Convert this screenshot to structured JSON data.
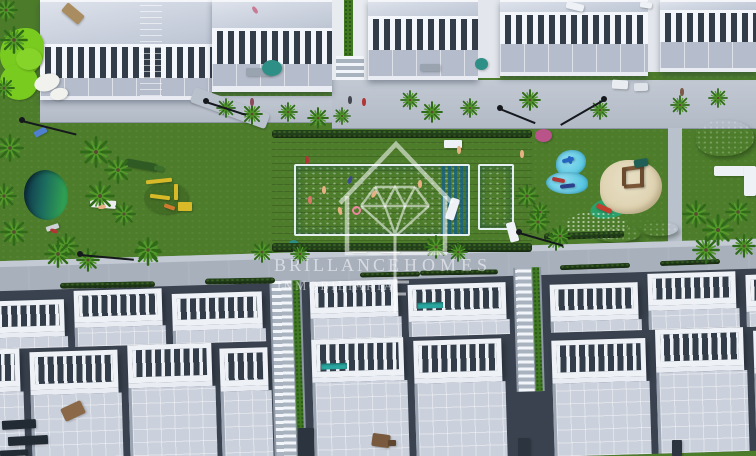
{
  "watermark": {
    "brand_left": "BRILLANCE",
    "brand_right": "HOMES",
    "subtitle": "INMOBILIARIA",
    "logo": "house-outline-with-diamond-and-plumb-line"
  },
  "colors": {
    "lawn": "#4d7d2b",
    "golf": "#79cb1f",
    "pool": "#2aa7da",
    "splash": "#58c7e2",
    "deck": "#84654c",
    "hedge": "#24421c",
    "white": "#eef1f6",
    "roof": "#c9d0dd",
    "terr": "#b5bdcc",
    "win": "#333d49",
    "road": "#a8b0bc",
    "walk": "#c3cad4",
    "sand": "#ddd1af",
    "pond": "#1b6b5e",
    "palm": "#3c7a1e",
    "wm": "rgba(255,255,255,0.55)"
  },
  "scene": {
    "palms": [
      {
        "x": 6,
        "y": 10,
        "s": 24
      },
      {
        "x": 14,
        "y": 40,
        "s": 28
      },
      {
        "x": 4,
        "y": 88,
        "s": 22
      },
      {
        "x": 10,
        "y": 148,
        "s": 28
      },
      {
        "x": 4,
        "y": 196,
        "s": 26
      },
      {
        "x": 14,
        "y": 232,
        "s": 28
      },
      {
        "x": 96,
        "y": 152,
        "s": 32
      },
      {
        "x": 118,
        "y": 170,
        "s": 28
      },
      {
        "x": 100,
        "y": 196,
        "s": 30
      },
      {
        "x": 124,
        "y": 214,
        "s": 24
      },
      {
        "x": 66,
        "y": 246,
        "s": 26
      },
      {
        "x": 148,
        "y": 252,
        "s": 28
      },
      {
        "x": 226,
        "y": 108,
        "s": 20
      },
      {
        "x": 252,
        "y": 114,
        "s": 22
      },
      {
        "x": 288,
        "y": 112,
        "s": 20
      },
      {
        "x": 318,
        "y": 118,
        "s": 22
      },
      {
        "x": 342,
        "y": 116,
        "s": 18
      },
      {
        "x": 410,
        "y": 100,
        "s": 20
      },
      {
        "x": 432,
        "y": 112,
        "s": 22
      },
      {
        "x": 470,
        "y": 108,
        "s": 20
      },
      {
        "x": 530,
        "y": 100,
        "s": 22
      },
      {
        "x": 600,
        "y": 110,
        "s": 20
      },
      {
        "x": 680,
        "y": 105,
        "s": 20
      },
      {
        "x": 718,
        "y": 98,
        "s": 20
      },
      {
        "x": 527,
        "y": 196,
        "s": 24
      },
      {
        "x": 540,
        "y": 212,
        "s": 20
      },
      {
        "x": 538,
        "y": 222,
        "s": 24
      },
      {
        "x": 556,
        "y": 240,
        "s": 22
      },
      {
        "x": 696,
        "y": 214,
        "s": 28
      },
      {
        "x": 718,
        "y": 230,
        "s": 32
      },
      {
        "x": 738,
        "y": 212,
        "s": 26
      },
      {
        "x": 706,
        "y": 250,
        "s": 28
      },
      {
        "x": 744,
        "y": 246,
        "s": 24
      },
      {
        "x": 58,
        "y": 254,
        "s": 28
      },
      {
        "x": 88,
        "y": 260,
        "s": 24
      },
      {
        "x": 148,
        "y": 250,
        "s": 26
      },
      {
        "x": 262,
        "y": 252,
        "s": 22
      },
      {
        "x": 300,
        "y": 254,
        "s": 20
      },
      {
        "x": 436,
        "y": 247,
        "s": 24
      },
      {
        "x": 458,
        "y": 252,
        "s": 20
      },
      {
        "x": 560,
        "y": 236,
        "s": 22
      }
    ],
    "lamps": [
      {
        "x": 22,
        "y": 120,
        "a": 14,
        "l": 56
      },
      {
        "x": 206,
        "y": 101,
        "a": 18,
        "l": 42
      },
      {
        "x": 604,
        "y": 99,
        "a": 150,
        "l": 50
      },
      {
        "x": 80,
        "y": 254,
        "a": 5,
        "l": 54
      },
      {
        "x": 519,
        "y": 232,
        "a": 16,
        "l": 46
      },
      {
        "x": 500,
        "y": 108,
        "a": 22,
        "l": 38
      }
    ],
    "people": [
      {
        "x": 253,
        "y": 6,
        "c": "#c97b93",
        "r": -35
      },
      {
        "x": 322,
        "y": 186,
        "c": "#e8b184",
        "r": 0
      },
      {
        "x": 348,
        "y": 176,
        "c": "#3b4a8c",
        "r": 20
      },
      {
        "x": 338,
        "y": 207,
        "c": "#e8b184",
        "r": -15
      },
      {
        "x": 308,
        "y": 196,
        "c": "#d77766",
        "r": 0
      },
      {
        "x": 372,
        "y": 190,
        "c": "#e8b184",
        "r": 30
      },
      {
        "x": 418,
        "y": 180,
        "c": "#e8b184",
        "r": 0
      },
      {
        "x": 457,
        "y": 146,
        "c": "#e8b184",
        "r": 0
      },
      {
        "x": 305,
        "y": 156,
        "c": "#b03636",
        "r": 0
      },
      {
        "x": 348,
        "y": 96,
        "c": "#44474f",
        "r": 0
      },
      {
        "x": 362,
        "y": 98,
        "c": "#b03636",
        "r": 0
      },
      {
        "x": 100,
        "y": 203,
        "c": "#e8b184",
        "r": 80
      },
      {
        "x": 52,
        "y": 227,
        "c": "#b03636",
        "r": -70
      },
      {
        "x": 520,
        "y": 150,
        "c": "#e8b184",
        "r": 0
      },
      {
        "x": 568,
        "y": 156,
        "c": "#2565c0",
        "r": -15
      },
      {
        "x": 680,
        "y": 88,
        "c": "#7a5a46",
        "r": 0
      },
      {
        "x": 250,
        "y": 98,
        "c": "#8a4a5a",
        "r": 0
      }
    ],
    "hedges": [
      {
        "x": 272,
        "y": 130,
        "w": 260,
        "h": 8,
        "r": 0
      },
      {
        "x": 272,
        "y": 243,
        "w": 260,
        "h": 9,
        "r": 0
      },
      {
        "x": 544,
        "y": 232,
        "w": 80,
        "h": 7,
        "r": -2
      },
      {
        "x": 60,
        "y": 282,
        "w": 95,
        "h": 6,
        "r": -1
      },
      {
        "x": 205,
        "y": 278,
        "w": 70,
        "h": 6,
        "r": -1
      },
      {
        "x": 360,
        "y": 272,
        "w": 60,
        "h": 5,
        "r": -1
      },
      {
        "x": 420,
        "y": 270,
        "w": 78,
        "h": 5,
        "r": -1
      },
      {
        "x": 560,
        "y": 264,
        "w": 70,
        "h": 5,
        "r": -2
      },
      {
        "x": 660,
        "y": 260,
        "w": 60,
        "h": 5,
        "r": -2
      }
    ],
    "props": [
      {
        "n": "golf-green",
        "x": 0,
        "y": 28,
        "w": 44,
        "h": 48,
        "c": "#79cb1f",
        "r": 0,
        "br": "60% 40% 55% 45%"
      },
      {
        "n": "golf-green",
        "x": 0,
        "y": 64,
        "w": 38,
        "h": 36,
        "c": "#79cb1f",
        "r": 0,
        "br": "50%"
      },
      {
        "n": "golf-green",
        "x": 16,
        "y": 48,
        "w": 26,
        "h": 22,
        "c": "#86d32a",
        "r": 0,
        "br": "50%"
      },
      {
        "n": "sand-bunker",
        "x": 34,
        "y": 74,
        "w": 26,
        "h": 17,
        "c": "#f1f2ee",
        "r": -18,
        "br": "50%"
      },
      {
        "n": "sand-bunker",
        "x": 50,
        "y": 88,
        "w": 18,
        "h": 12,
        "c": "#f1f2ee",
        "r": -12,
        "br": "50%"
      },
      {
        "n": "roof-lounger",
        "x": 62,
        "y": 8,
        "w": 22,
        "h": 11,
        "c": "#a98c5f",
        "r": 40,
        "br": "2px"
      },
      {
        "n": "roof-lounger",
        "x": 566,
        "y": 3,
        "w": 18,
        "h": 7,
        "c": "#eef2f7",
        "r": 14,
        "br": "2px"
      },
      {
        "n": "roof-lounger",
        "x": 640,
        "y": 2,
        "w": 12,
        "h": 6,
        "c": "#eef2f7",
        "r": 8,
        "br": "2px"
      },
      {
        "n": "planter",
        "x": 246,
        "y": 68,
        "w": 26,
        "h": 8,
        "c": "#9aa3b0",
        "r": 0,
        "br": "1px"
      },
      {
        "n": "planter",
        "x": 420,
        "y": 64,
        "w": 20,
        "h": 7,
        "c": "#9aa3b0",
        "r": 0,
        "br": "1px"
      },
      {
        "n": "parked-car",
        "x": 612,
        "y": 80,
        "w": 16,
        "h": 9,
        "c": "#e9edf2",
        "r": 3,
        "br": "2px"
      },
      {
        "n": "parked-car",
        "x": 634,
        "y": 83,
        "w": 14,
        "h": 8,
        "c": "#dfe4ea",
        "r": -2,
        "br": "2px"
      },
      {
        "n": "umbrella",
        "x": 475,
        "y": 58,
        "w": 13,
        "h": 12,
        "c": "#2e8f86",
        "r": 0,
        "br": "50%"
      },
      {
        "n": "umbrella",
        "x": 262,
        "y": 60,
        "w": 20,
        "h": 16,
        "c": "#2e8f86",
        "r": 0,
        "br": "50%"
      },
      {
        "n": "umbrella",
        "x": 288,
        "y": 240,
        "w": 11,
        "h": 10,
        "c": "#2e8f86",
        "r": 0,
        "br": "50%"
      },
      {
        "n": "pool-bench",
        "x": 444,
        "y": 140,
        "w": 18,
        "h": 8,
        "c": "#eef2f7",
        "r": 0,
        "br": "1px"
      },
      {
        "n": "lounger",
        "x": 448,
        "y": 198,
        "w": 9,
        "h": 22,
        "c": "#eef2f7",
        "r": 18,
        "br": "2px"
      },
      {
        "n": "lounger",
        "x": 508,
        "y": 222,
        "w": 9,
        "h": 20,
        "c": "#eef2f7",
        "r": -15,
        "br": "2px"
      },
      {
        "n": "lounger",
        "x": 380,
        "y": 247,
        "w": 20,
        "h": 6,
        "c": "#eef2f7",
        "r": 2,
        "br": "1px"
      },
      {
        "n": "lounger",
        "x": 352,
        "y": 248,
        "w": 15,
        "h": 5,
        "c": "#dfe4df",
        "r": 0,
        "br": "1px"
      },
      {
        "n": "towel",
        "x": 90,
        "y": 200,
        "w": 26,
        "h": 8,
        "c": "#eceef1",
        "r": 4,
        "br": "1px"
      },
      {
        "n": "towel",
        "x": 34,
        "y": 129,
        "w": 13,
        "h": 6,
        "c": "#4f7fd0",
        "r": -28,
        "br": "1px"
      },
      {
        "n": "towel",
        "x": 46,
        "y": 225,
        "w": 13,
        "h": 5,
        "c": "#cfd3d8",
        "r": -18,
        "br": "1px"
      },
      {
        "n": "crocodile-sculpture",
        "x": 124,
        "y": 161,
        "w": 34,
        "h": 8,
        "c": "#2f5a23",
        "r": 10,
        "br": "4px"
      },
      {
        "n": "crocodile-sculpture",
        "x": 154,
        "y": 166,
        "w": 10,
        "h": 5,
        "c": "#3c6e2c",
        "r": 10,
        "br": "2px"
      },
      {
        "n": "playground-shadow",
        "x": 144,
        "y": 182,
        "w": 44,
        "h": 32,
        "c": "rgba(20,40,10,0.18)",
        "r": 0,
        "br": "50%"
      },
      {
        "n": "playground-swing",
        "x": 146,
        "y": 179,
        "w": 26,
        "h": 4,
        "c": "#d8b928",
        "r": -6,
        "br": "1px"
      },
      {
        "n": "playground-bar",
        "x": 150,
        "y": 195,
        "w": 20,
        "h": 4,
        "c": "#d8b928",
        "r": 7,
        "br": "1px"
      },
      {
        "n": "playground-pole",
        "x": 174,
        "y": 184,
        "w": 4,
        "h": 16,
        "c": "#d8b928",
        "r": 0,
        "br": "1px"
      },
      {
        "n": "playground-house",
        "x": 178,
        "y": 202,
        "w": 14,
        "h": 9,
        "c": "#d8b928",
        "r": 0,
        "br": "1px"
      },
      {
        "n": "playground-slide",
        "x": 164,
        "y": 205,
        "w": 11,
        "h": 4,
        "c": "#cf7a2e",
        "r": 20,
        "br": "1px"
      },
      {
        "n": "dolphin-figure",
        "x": 562,
        "y": 158,
        "w": 12,
        "h": 4,
        "c": "#2565c0",
        "r": -15,
        "br": "2px"
      },
      {
        "n": "shark-figure",
        "x": 552,
        "y": 178,
        "w": 13,
        "h": 4,
        "c": "#b03636",
        "r": 12,
        "br": "2px"
      },
      {
        "n": "shark-figure",
        "x": 560,
        "y": 184,
        "w": 15,
        "h": 4,
        "c": "#2b3f8a",
        "r": -6,
        "br": "2px"
      },
      {
        "n": "kids-slide",
        "x": 596,
        "y": 206,
        "w": 16,
        "h": 5,
        "c": "#c23d2e",
        "r": 24,
        "br": "2px"
      },
      {
        "n": "play-structure-beam",
        "x": 622,
        "y": 166,
        "w": 22,
        "h": 4,
        "c": "#7a5636",
        "r": -8,
        "br": "1px"
      },
      {
        "n": "play-structure-beam",
        "x": 624,
        "y": 184,
        "w": 20,
        "h": 4,
        "c": "#7a5636",
        "r": -4,
        "br": "1px"
      },
      {
        "n": "play-structure-post",
        "x": 622,
        "y": 168,
        "w": 4,
        "h": 18,
        "c": "#6b4a2e",
        "r": 0,
        "br": "1px"
      },
      {
        "n": "play-structure-post",
        "x": 640,
        "y": 166,
        "w": 4,
        "h": 20,
        "c": "#6b4a2e",
        "r": 0,
        "br": "1px"
      },
      {
        "n": "shade-sail",
        "x": 634,
        "y": 159,
        "w": 14,
        "h": 8,
        "c": "#1f5f56",
        "r": -10,
        "br": "2px"
      },
      {
        "n": "garden-bench",
        "x": 714,
        "y": 166,
        "w": 42,
        "h": 10,
        "c": "#eef2f7",
        "r": 0,
        "br": "2px"
      },
      {
        "n": "garden-bench",
        "x": 744,
        "y": 166,
        "w": 12,
        "h": 30,
        "c": "#eef2f7",
        "r": 0,
        "br": "2px"
      },
      {
        "n": "flower-bush",
        "x": 535,
        "y": 129,
        "w": 17,
        "h": 13,
        "c": "#b9538a",
        "r": 0,
        "br": "50%"
      },
      {
        "n": "terrace-chair",
        "x": 62,
        "y": 404,
        "w": 22,
        "h": 14,
        "c": "#8a6848",
        "r": -25,
        "br": "2px"
      },
      {
        "n": "terrace-table",
        "x": 372,
        "y": 434,
        "w": 18,
        "h": 13,
        "c": "#7a5a3e",
        "r": 8,
        "br": "2px"
      },
      {
        "n": "terrace-table",
        "x": 388,
        "y": 440,
        "w": 8,
        "h": 6,
        "c": "#5f452f",
        "r": 0,
        "br": "1px"
      },
      {
        "n": "dark-planter",
        "x": 2,
        "y": 420,
        "w": 34,
        "h": 9,
        "c": "#222a33",
        "r": -3,
        "br": "1px"
      },
      {
        "n": "dark-planter",
        "x": 8,
        "y": 436,
        "w": 40,
        "h": 9,
        "c": "#222a33",
        "r": -3,
        "br": "1px"
      },
      {
        "n": "dark-planter",
        "x": 0,
        "y": 450,
        "w": 28,
        "h": 6,
        "c": "#222a33",
        "r": -3,
        "br": "1px"
      },
      {
        "n": "alley-slot",
        "x": 298,
        "y": 428,
        "w": 16,
        "h": 28,
        "c": "#2b343f",
        "r": 0,
        "br": "1px"
      },
      {
        "n": "alley-slot",
        "x": 518,
        "y": 438,
        "w": 12,
        "h": 18,
        "c": "#2b343f",
        "r": 0,
        "br": "1px"
      },
      {
        "n": "alley-slot",
        "x": 672,
        "y": 440,
        "w": 10,
        "h": 16,
        "c": "#2b343f",
        "r": 0,
        "br": "1px"
      },
      {
        "n": "side-path",
        "x": 190,
        "y": 100,
        "w": 80,
        "h": 16,
        "c": "#b9c1cc",
        "r": 20,
        "br": "3px"
      }
    ],
    "estate": {
      "row1": [
        {
          "x": 0,
          "w": 90,
          "dy": 10
        },
        {
          "x": 100,
          "w": 88,
          "dy": 2
        },
        {
          "x": 198,
          "w": 90,
          "dy": 8
        },
        {
          "x": 336,
          "w": 88,
          "dy": 0
        },
        {
          "x": 434,
          "w": 98,
          "dy": 6,
          "pool": 1
        },
        {
          "x": 576,
          "w": 88,
          "dy": 10
        },
        {
          "x": 674,
          "w": 88,
          "dy": 2
        },
        {
          "x": 772,
          "w": 58,
          "dy": 6
        }
      ],
      "row2": [
        {
          "x": -46,
          "w": 90,
          "dy": 0
        },
        {
          "x": 54,
          "w": 88,
          "dy": 4
        },
        {
          "x": 152,
          "w": 84,
          "dy": 0
        },
        {
          "x": 244,
          "w": 48,
          "dy": 6
        },
        {
          "x": 336,
          "w": 92,
          "dy": 0,
          "pool": 1
        },
        {
          "x": 438,
          "w": 88,
          "dy": 4
        },
        {
          "x": 576,
          "w": 94,
          "dy": 8
        },
        {
          "x": 680,
          "w": 88,
          "dy": 0
        },
        {
          "x": 778,
          "w": 52,
          "dy": 4
        }
      ],
      "alleys": [
        {
          "x": 296,
          "y": 6,
          "w": 32,
          "h": 178
        },
        {
          "x": 540,
          "y": 0,
          "w": 28,
          "h": 124
        }
      ]
    }
  }
}
